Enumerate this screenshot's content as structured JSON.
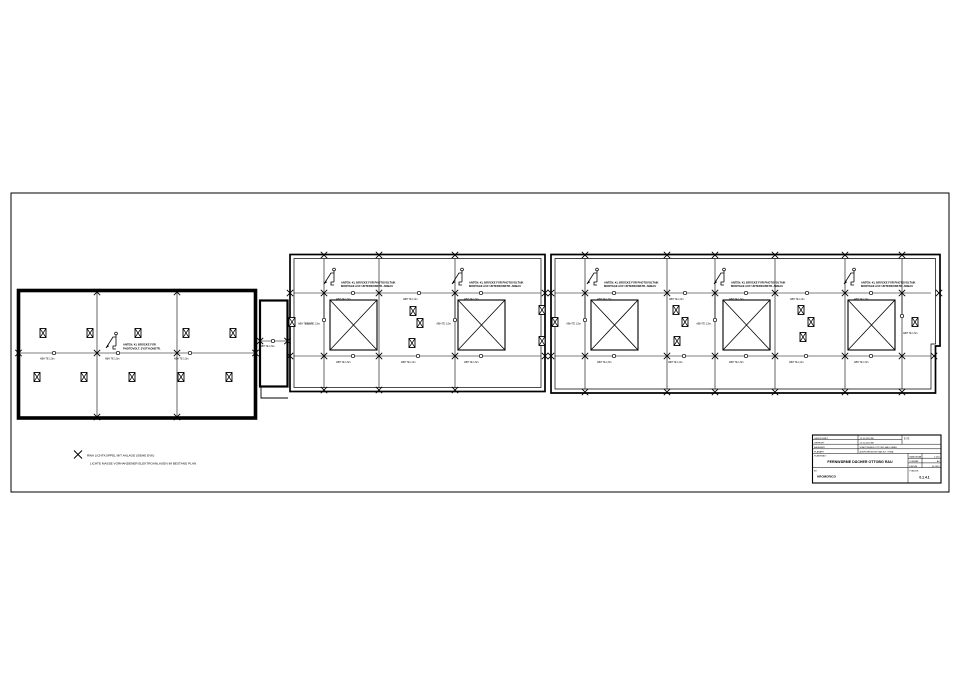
{
  "drawing": {
    "fixture_label_15": "ABH TE 1,5m",
    "fixture_label_10": "ABH TE 1,0m",
    "left_annotation": {
      "line1": "ANTEN. KL BRÜCKE FÜR",
      "line2": "PHOTOVOLT. SYST-KONSTR."
    },
    "roof_annotation": {
      "line1": "ANTEN. KL BRÜCKE FÜR PHOTOVOLTAIK",
      "line2": "MONTAGE AUF UNTERKONSTR. ANBAU"
    },
    "legend": {
      "line1": "RWA LICHTKUPPEL MIT ANLAGE (SIEHE EVK)",
      "line2": "LICHTE MASSE VORHANDENER ELEKTROANLAGEN IM BESTAND PLAN"
    },
    "title_block": {
      "row1_label": "GEZEICHNET",
      "row1_value": "12.10.2023  BK",
      "row2_label": "GEPRÜFT",
      "row2_value": "12.10.2023  BK",
      "revision": "E 03",
      "row3_label": "BAUHERR",
      "row3_value": "STADTWERKE OTTOBG RAU GMBH",
      "row4_label": "PLANART",
      "row4_value": "AUSFÜHRUNGSPLAN ELT / RWA",
      "title_label": "PLANINHALT",
      "title": "FERNWÄRME DÄCHER OTTOBG RAU",
      "scale_label": "MASSSTAB",
      "scale_value": "1:100",
      "format_label": "FORMAT",
      "format_value": "A3",
      "date_label": "DATUM",
      "date_value": "10.2023",
      "company_label": "BV:",
      "company": "HROMORICO",
      "plan_no_label": "PLAN-NR.",
      "plan_no": "0.1.4.1"
    }
  }
}
